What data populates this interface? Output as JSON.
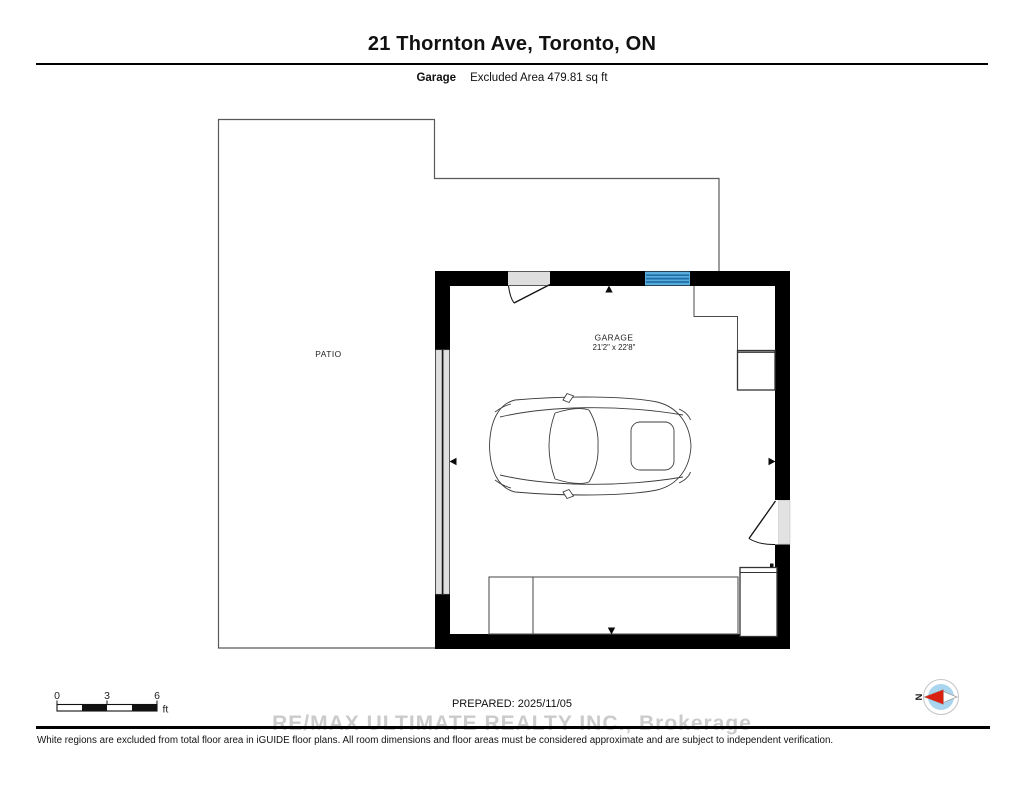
{
  "header": {
    "title": "21 Thornton Ave, Toronto, ON",
    "floor_label": "Garage",
    "area_note": "Excluded Area 479.81 sq ft"
  },
  "plan": {
    "rooms": [
      {
        "name": "PATIO"
      },
      {
        "name": "GARAGE",
        "dimensions": "21'2\" x 22'8\""
      }
    ]
  },
  "footer": {
    "scale_bar": {
      "tick0": "0",
      "tick1": "3",
      "tick2": "6",
      "unit": "ft"
    },
    "prepared": "PREPARED: 2025/11/05",
    "watermark": "RE/MAX ULTIMATE REALTY INC., Brokerage",
    "disclaimer": "White regions are excluded from total floor area in iGUIDE floor plans. All room dimensions and floor areas must be considered approximate and are subject to independent verification.",
    "compass": {
      "label": "N"
    }
  },
  "colors": {
    "wall": "#000000",
    "window_blue": "#58acdc",
    "window_blue_stripe": "#1e6ea6",
    "door_fill": "#dedede",
    "patio_outline": "#595959",
    "watermark_gray": "#cbcbcb",
    "compass_inner": "#a9d5ef",
    "compass_needle_red": "#d92011"
  }
}
